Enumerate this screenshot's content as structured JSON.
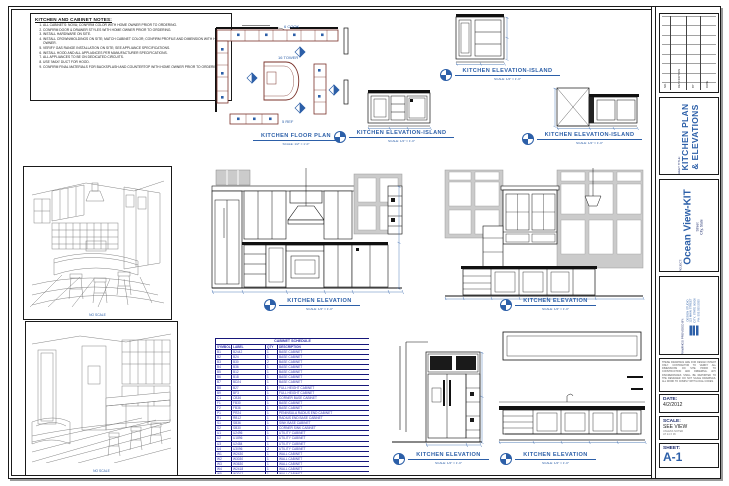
{
  "notes": {
    "title": "KITCHEN AND CABINET NOTES:",
    "items": [
      "ALL CABINETS: NOVA; CONFIRM COLOR WITH HOME OWNER PRIOR TO ORDERING.",
      "CONFIRM DOOR & DRAWER STYLES WITH HOME OWNER PRIOR TO ORDERING.",
      "INSTALL HARDWARE ON SITE.",
      "INSTALL CROWN/MOLDINGS ON SITE; MATCH CABINET COLOR; CONFIRM PROFILE AND DIMENSION WITH HOME OWNER.",
      "VERIFY GAS RANGE INSTALLATION ON SITE; SEE APPLIANCE SPECIFICATIONS.",
      "INSTALL HOOD AND ALL APPLIANCES PER MANUFACTURER SPECIFICATIONS.",
      "ALL APPLIANCES TO BE ON DEDICATED CIRCUITS.",
      "USE 'MAXI' DUCT FOR HOOD.",
      "CONFIRM FINAL MATERIALS FOR BACKSPLASH AND COUNTERTOP WITH HOME OWNER PRIOR TO ORDERING."
    ]
  },
  "plan": {
    "labels": [
      "6 COOK",
      "16 TOWER",
      "5 REF"
    ]
  },
  "drawings": {
    "floor_plan": {
      "title": "KITCHEN FLOOR PLAN",
      "scale": "SCALE: 1/2\" = 1'-0\""
    },
    "island_top": {
      "title": "KITCHEN ELEVATION-ISLAND",
      "scale": "SCALE: 1/2\" = 1'-0\""
    },
    "island_left": {
      "title": "KITCHEN ELEVATION-ISLAND",
      "scale": "SCALE: 1/2\" = 1'-0\""
    },
    "island_right": {
      "title": "KITCHEN ELEVATION-ISLAND",
      "scale": "SCALE: 1/2\" = 1'-0\""
    },
    "elev_mid_left": {
      "title": "KITCHEN ELEVATION",
      "scale": "SCALE: 1/2\" = 1'-0\""
    },
    "elev_mid_right": {
      "title": "KITCHEN ELEVATION",
      "scale": "SCALE: 1/2\" = 1'-0\""
    },
    "elev_bot_left": {
      "title": "KITCHEN ELEVATION",
      "scale": "SCALE: 1/2\" = 1'-0\""
    },
    "elev_bot_right": {
      "title": "KITCHEN ELEVATION",
      "scale": "SCALE: 1/2\" = 1'-0\""
    }
  },
  "persp": {
    "label": "NO SCALE"
  },
  "schedule": {
    "title": "CABINET SCHEDULE",
    "columns": [
      "SYMBOL",
      "LABEL",
      "QTY",
      "DESCRIPTION"
    ],
    "rows": [
      {
        "symbol": "B1",
        "label": "B2442",
        "qty": "1",
        "desc": "BASE CABINET"
      },
      {
        "symbol": "B2",
        "label": "B24",
        "qty": "1",
        "desc": "BASE CABINET"
      },
      {
        "symbol": "B3",
        "label": "B30",
        "qty": "2",
        "desc": "BASE CABINET"
      },
      {
        "symbol": "B4",
        "label": "B36",
        "qty": "1",
        "desc": "BASE CABINET"
      },
      {
        "symbol": "B5",
        "label": "B12",
        "qty": "1",
        "desc": "BASE CABINET"
      },
      {
        "symbol": "B6",
        "label": "B18",
        "qty": "1",
        "desc": "BASE CABINET"
      },
      {
        "symbol": "B7",
        "label": "BD24",
        "qty": "1",
        "desc": "BASE CABINET"
      },
      {
        "symbol": "B8",
        "label": "B27",
        "qty": "1",
        "desc": "FULL HEIGHT CABINET"
      },
      {
        "symbol": "B9",
        "label": "BF3",
        "qty": "1",
        "desc": "FULL HEIGHT CABINET"
      },
      {
        "symbol": "C1",
        "label": "CB36",
        "qty": "1",
        "desc": "CORNER BASE CABINET"
      },
      {
        "symbol": "F1",
        "label": "FB30",
        "qty": "1",
        "desc": "BASE CABINET"
      },
      {
        "symbol": "F2",
        "label": "FB36",
        "qty": "1",
        "desc": "BASE CABINET"
      },
      {
        "symbol": "P1",
        "label": "PR24",
        "qty": "1",
        "desc": "PENINSULA RADIUS END CABINET"
      },
      {
        "symbol": "R1",
        "label": "RB12",
        "qty": "1",
        "desc": "RADIUS END BASE CABINET"
      },
      {
        "symbol": "S1",
        "label": "SB36",
        "qty": "1",
        "desc": "SINK BASE CABINET"
      },
      {
        "symbol": "S2",
        "label": "SB30",
        "qty": "1",
        "desc": "CORNER SINK CABINET"
      },
      {
        "symbol": "U1",
        "label": "U2496",
        "qty": "1",
        "desc": "UTILITY CABINET"
      },
      {
        "symbol": "U2",
        "label": "U1896",
        "qty": "1",
        "desc": "UTILITY CABINET"
      },
      {
        "symbol": "U3",
        "label": "U2484",
        "qty": "1",
        "desc": "UTILITY CABINET"
      },
      {
        "symbol": "U4",
        "label": "U3096",
        "qty": "2",
        "desc": "UTILITY CABINET"
      },
      {
        "symbol": "W1",
        "label": "W2430",
        "qty": "1",
        "desc": "WALL CABINET"
      },
      {
        "symbol": "W2",
        "label": "W3030",
        "qty": "1",
        "desc": "WALL CABINET"
      },
      {
        "symbol": "W3",
        "label": "W3630",
        "qty": "1",
        "desc": "WALL CABINET"
      },
      {
        "symbol": "W4",
        "label": "W2418",
        "qty": "1",
        "desc": "WALL CABINET"
      },
      {
        "symbol": "W5",
        "label": "W3012",
        "qty": "1",
        "desc": "WALL CABINET"
      },
      {
        "symbol": "W6",
        "label": "W1530",
        "qty": "1",
        "desc": "WALL CABINET"
      },
      {
        "symbol": "W7",
        "label": "W3615",
        "qty": "1",
        "desc": "WALL CABINET"
      },
      {
        "symbol": "W8",
        "label": "W2442",
        "qty": "2",
        "desc": "WALL CABINET"
      }
    ]
  },
  "titleblock": {
    "revisions": {
      "columns": [
        "NO.",
        "DESCRIPTION",
        "BY",
        "DATE"
      ]
    },
    "sheet_title_label": "SHEET TITLE:",
    "sheet_title_line1": "KITCHEN PLAN",
    "sheet_title_line2": "& ELEVATIONS",
    "project_label": "PROJECT:",
    "project_name": "Ocean View-KIT",
    "project_street": "Street",
    "project_city": "City, State",
    "firm_label": "DRAWINGS PROVIDED BY:",
    "firm_lines": [
      "DESIGN STUDIO",
      "123 MAIN STREET",
      "CITY, STATE 00000",
      "PH: 555.555.5555"
    ],
    "disclaimer": "THESE DRAWINGS ARE FOR DESIGN INTENT ONLY. CONTRACTOR TO VERIFY ALL DIMENSIONS ON SITE PRIOR TO CONSTRUCTION AND ORDERING. ANY DISCREPANCIES SHALL BE REPORTED TO THE DESIGNER. DO NOT SCALE DRAWINGS. ALL WORK TO COMPLY WITH LOCAL CODES.",
    "date_label": "DATE:",
    "date_value": "4/2/2012",
    "scale_label": "SCALE:",
    "scale_value": "SEE VIEW",
    "scale_note1": "UNLESS NOTED",
    "scale_note2": "AT 24 X 36",
    "sheet_label": "SHEET:",
    "sheet_number": "A-1"
  },
  "colors": {
    "accent_blue": "#2c5fa8",
    "plan_maroon": "#7a322a",
    "table_navy": "#16167a",
    "shade_gray": "#cbcbcb"
  }
}
